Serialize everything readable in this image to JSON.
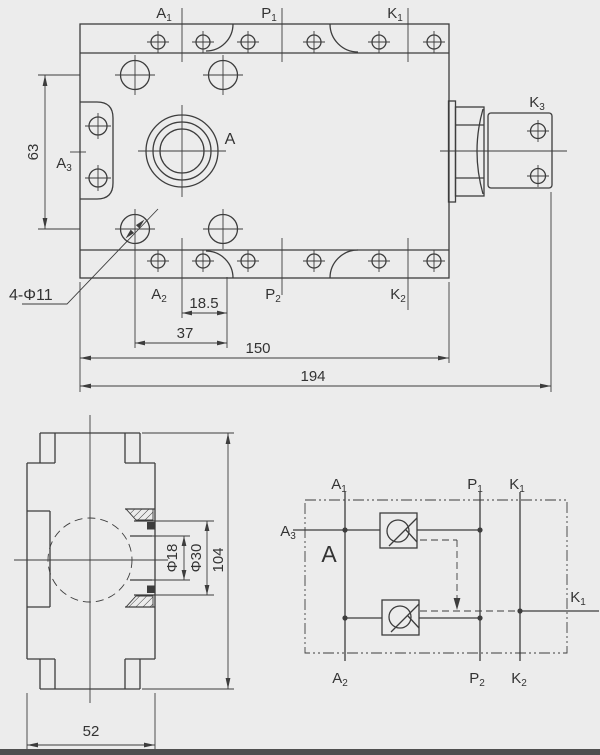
{
  "colors": {
    "background": "#ececec",
    "line": "#3d3d3d",
    "text": "#333333",
    "bottom_bar": "#4f4f4f"
  },
  "front_view": {
    "labels": {
      "a1": {
        "main": "A",
        "sub": "1"
      },
      "p1": {
        "main": "P",
        "sub": "1"
      },
      "k1": {
        "main": "K",
        "sub": "1"
      },
      "a3": {
        "main": "A",
        "sub": "3"
      },
      "a": "A",
      "k3": {
        "main": "K",
        "sub": "3"
      },
      "a2": {
        "main": "A",
        "sub": "2"
      },
      "p2": {
        "main": "P",
        "sub": "2"
      },
      "k2": {
        "main": "K",
        "sub": "2"
      }
    },
    "dims": {
      "height_63": "63",
      "holes_callout": "4-Φ11",
      "pitch_18_5": "18.5",
      "pitch_37": "37",
      "length_150": "150",
      "length_194": "194"
    }
  },
  "side_view": {
    "dims": {
      "dia_18": "Φ18",
      "dia_30": "Φ30",
      "height_104": "104",
      "width_52": "52"
    }
  },
  "schematic": {
    "labels": {
      "a1": {
        "main": "A",
        "sub": "1"
      },
      "p1": {
        "main": "P",
        "sub": "1"
      },
      "k1_top": {
        "main": "K",
        "sub": "1"
      },
      "a3": {
        "main": "A",
        "sub": "3"
      },
      "a_marker": "A",
      "k1_right": {
        "main": "K",
        "sub": "1"
      },
      "a2": {
        "main": "A",
        "sub": "2"
      },
      "p2": {
        "main": "P",
        "sub": "2"
      },
      "k2": {
        "main": "K",
        "sub": "2"
      }
    }
  }
}
